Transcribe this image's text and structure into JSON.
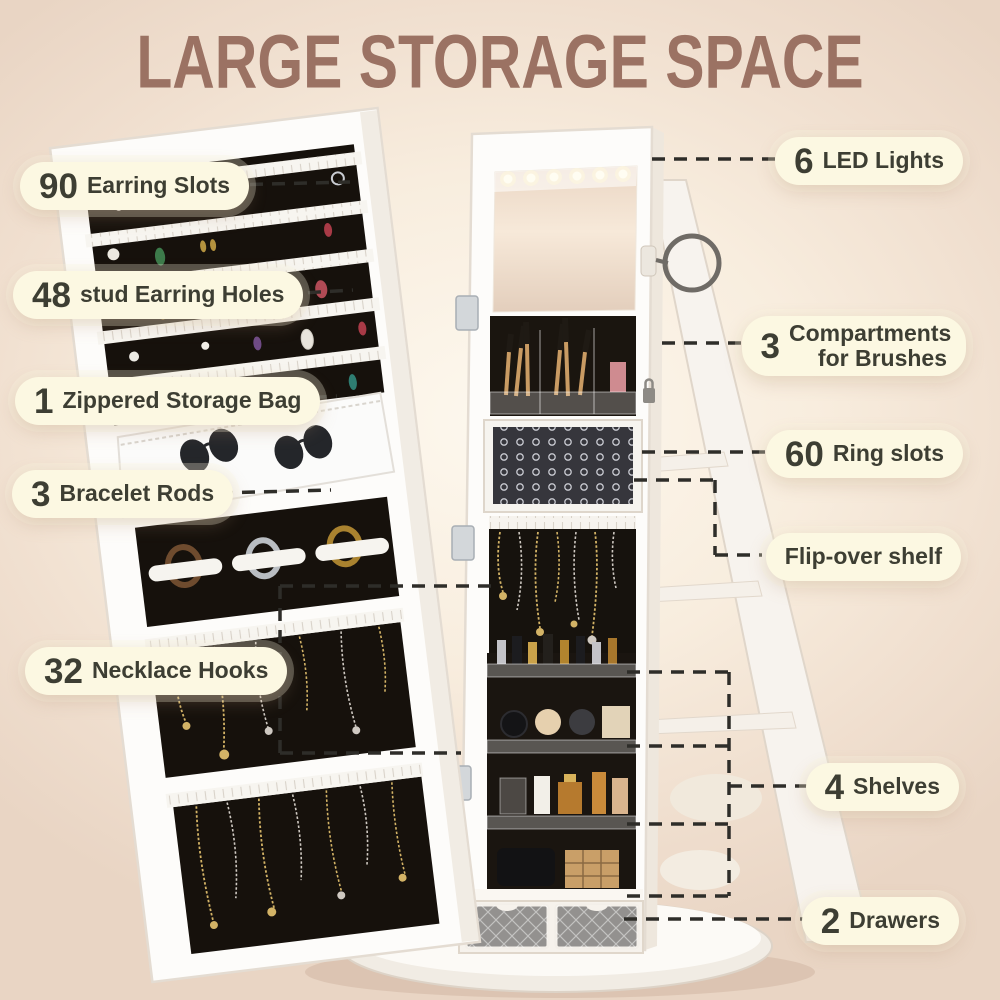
{
  "title": "LARGE STORAGE SPACE",
  "colors": {
    "title_text": "#9b7263",
    "pill_background": "#fcf8e2",
    "pill_text": "#3d3e33",
    "connector_line": "#2e2d29",
    "background_center": "#fdf8ee",
    "background_edge": "#e9d5c4",
    "cabinet_white": "#fdfcfa",
    "felt_black": "#16110c"
  },
  "callouts": {
    "left": [
      {
        "id": "earring-slots",
        "number": "90",
        "label": "Earring Slots"
      },
      {
        "id": "stud-earring-holes",
        "number": "48",
        "label": "stud Earring Holes"
      },
      {
        "id": "zippered-storage-bag",
        "number": "1",
        "label": "Zippered Storage Bag"
      },
      {
        "id": "bracelet-rods",
        "number": "3",
        "label": "Bracelet Rods"
      },
      {
        "id": "necklace-hooks",
        "number": "32",
        "label": "Necklace Hooks"
      }
    ],
    "right": [
      {
        "id": "led-lights",
        "number": "6",
        "label": "LED Lights"
      },
      {
        "id": "brush-compartments",
        "number": "3",
        "label": "Compartments for Brushes"
      },
      {
        "id": "ring-slots",
        "number": "60",
        "label": "Ring slots"
      },
      {
        "id": "flip-over-shelf",
        "number": "",
        "label": "Flip-over shelf"
      },
      {
        "id": "shelves",
        "number": "4",
        "label": "Shelves"
      },
      {
        "id": "drawers",
        "number": "2",
        "label": "Drawers"
      }
    ]
  }
}
